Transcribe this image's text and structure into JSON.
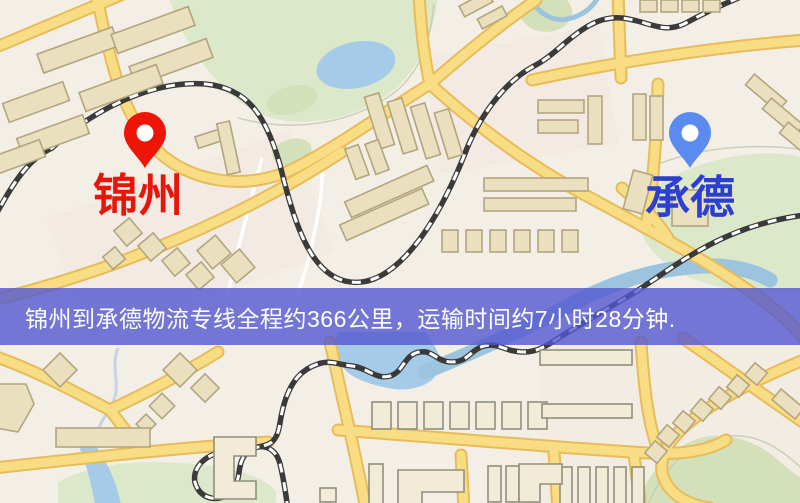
{
  "banner": {
    "text": "锦州到承德物流专线全程约366公里，运输时间约7小时28分钟."
  },
  "map": {
    "markers": [
      {
        "name": "jinzhou",
        "label": "锦州"
      },
      {
        "name": "chengde",
        "label": "承德"
      }
    ]
  },
  "colors": {
    "map-bg": "#f4efe6",
    "district-tint": "#f2e6df",
    "green": "#dce8ca",
    "green-dark": "#d4e0ba",
    "water": "#a5cbe8",
    "water-river": "#9cc4de",
    "stream": "#c6d4e4",
    "contour": "#c4cdb2",
    "path-white": "#ffffff",
    "road-casing": "#e7bc5a",
    "road-core": "#f8dd84",
    "rail": "#3a3a3a",
    "building-fill": "#eadfbe",
    "building-stroke": "#b3a67e",
    "building-fill-light": "#f1ebd8",
    "banner-bg": "rgba(82,88,208,0.80)",
    "banner-text": "#ffffff",
    "pin-red": "#ee1507",
    "pin-blue": "#5b8bee",
    "label-red": "#e8150b",
    "label-blue": "#2c3fd1"
  }
}
